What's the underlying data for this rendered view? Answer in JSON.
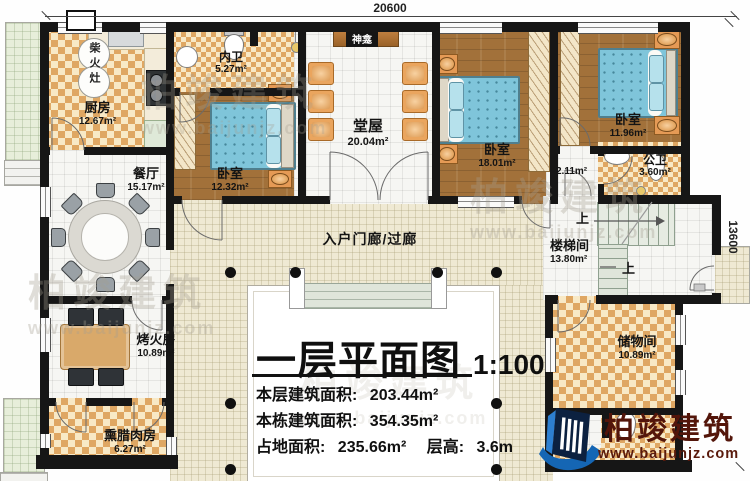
{
  "dimensions": {
    "width_mm": "20600",
    "height_mm": "13600"
  },
  "rooms": {
    "kitchen": {
      "name": "厨房",
      "area": "12.67m²"
    },
    "wood_stove": {
      "name": "柴火灶"
    },
    "ensuite_bath": {
      "name": "内卫",
      "area": "5.27m²"
    },
    "shrine": {
      "name": "神龛"
    },
    "hall": {
      "name": "堂屋",
      "area": "20.04m²"
    },
    "bedroom_left": {
      "name": "卧室",
      "area": "12.32m²"
    },
    "bedroom_middle": {
      "name": "卧室",
      "area": "18.01m²"
    },
    "bedroom_right": {
      "name": "卧室",
      "area": "11.96m²"
    },
    "dining_room": {
      "name": "餐厅",
      "area": "15.17m²"
    },
    "dressing": {
      "area": "2.11m²"
    },
    "public_bath": {
      "name": "公卫",
      "area": "3.60m²"
    },
    "entry_porch": {
      "name": "入户门廊/过廊"
    },
    "stairwell": {
      "name": "楼梯间",
      "area": "13.80m²",
      "up_label": "上"
    },
    "heating_room": {
      "name": "烤火房",
      "area": "10.89m²"
    },
    "storage_room": {
      "name": "储物间",
      "area": "10.89m²"
    },
    "bacon_room": {
      "name": "熏腊肉房",
      "area": "6.27m²"
    }
  },
  "title_block": {
    "title": "一层平面图",
    "scale": "1:100",
    "line1_label": "本层建筑面积:",
    "line1_value": "203.44m²",
    "line2_label": "本栋建筑面积:",
    "line2_value": "354.35m²",
    "line3_label": "占地面积:",
    "line3_value": "235.66m²",
    "line3b_label": "层高:",
    "line3b_value": "3.6m"
  },
  "branding": {
    "company": "柏竣建筑",
    "website": "www.baijunjz.com",
    "logo_navy": "#0c2140",
    "logo_blue": "#1566b4",
    "text_color": "#53150a"
  },
  "watermark": {
    "text": "柏竣建筑",
    "url": "www.baijunjz.com"
  }
}
